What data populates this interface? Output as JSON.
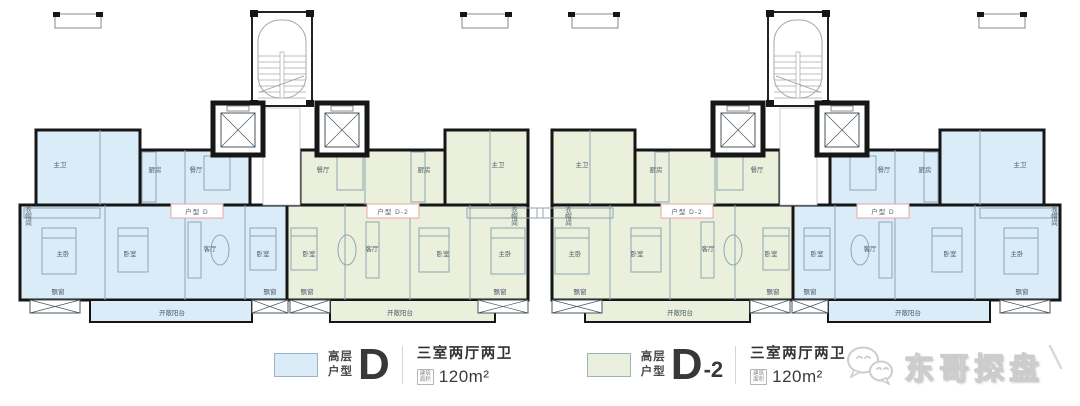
{
  "page": {
    "background": "#ffffff"
  },
  "floorplan": {
    "colors": {
      "unit_d": "#d9ecf7",
      "unit_d2": "#eaf0dc",
      "wall": "#161616",
      "thin": "#8fa6b4",
      "badge_red": "#d9534f",
      "badge_border": "#e8a6a2"
    },
    "unit_badges": [
      {
        "label": "户型  D",
        "type": "D"
      },
      {
        "label": "户型  D-2",
        "type": "D-2"
      },
      {
        "label": "户型  D-2",
        "type": "D-2"
      },
      {
        "label": "户型  D",
        "type": "D"
      }
    ],
    "room_labels": {
      "master_bedroom": "主卧",
      "bedroom": "卧室",
      "living_room": "客厅",
      "dining_room": "餐厅",
      "kitchen": "厨房",
      "master_bath": "主卫",
      "cloakroom": "衣帽间",
      "bay_window": "飘窗",
      "open_balcony": "开敞阳台"
    }
  },
  "legend": [
    {
      "category_line1": "高层",
      "category_line2": "户型",
      "code_main": "D",
      "code_sub": "",
      "layout": "三室两厅两卫",
      "area_badge_line1": "建筑",
      "area_badge_line2": "面积",
      "area": "120m²",
      "swatch_color": "#d9ecf7"
    },
    {
      "category_line1": "高层",
      "category_line2": "户型",
      "code_main": "D",
      "code_sub": "-2",
      "layout": "三室两厅两卫",
      "area_badge_line1": "建筑",
      "area_badge_line2": "面积",
      "area": "120m²",
      "swatch_color": "#eaf0dc"
    }
  ],
  "watermark": {
    "text": "东哥探盘",
    "logo": "wechat-icon"
  }
}
